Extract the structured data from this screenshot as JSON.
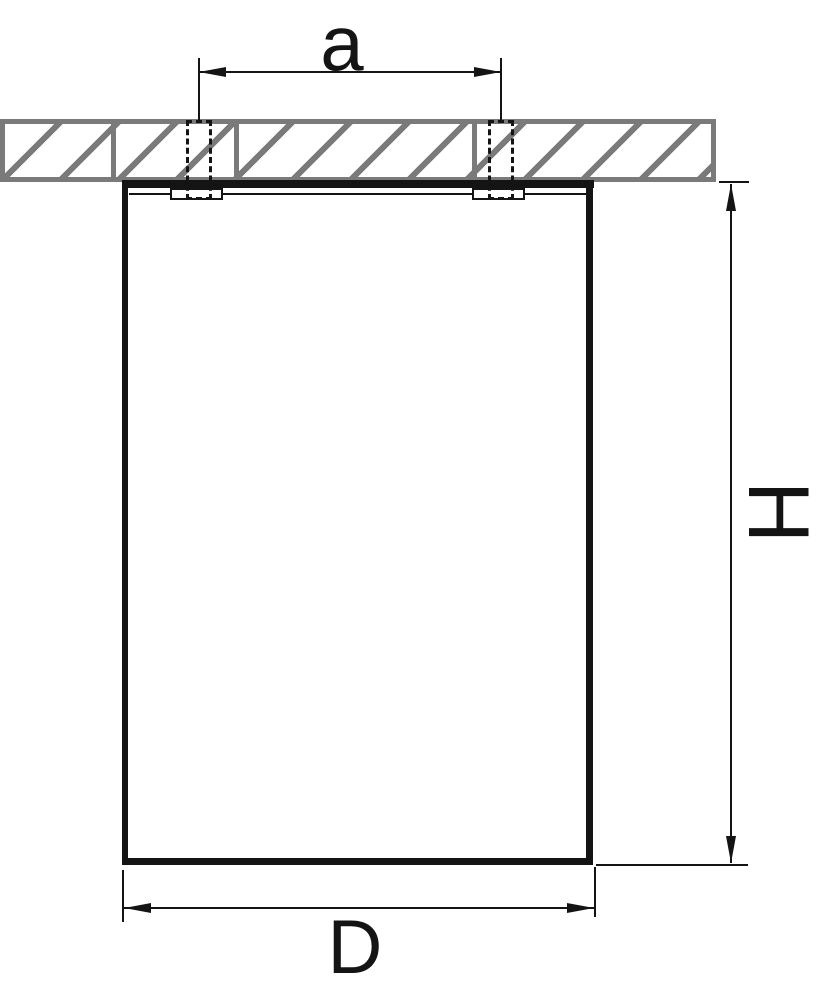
{
  "diagram": {
    "type": "technical-dimension-drawing",
    "subject": "surface-mounted cylindrical ceiling light fixture, side cross-section view",
    "dimension_labels": {
      "mounting_hole_spacing": "a",
      "fixture_height": "H",
      "fixture_diameter": "D"
    },
    "parts": [
      "ceiling cross-section (hatched)",
      "left mounting screw (hidden outline, dashed)",
      "right mounting screw (hidden outline, dashed)",
      "fixture body (cylinder outline)"
    ],
    "colors": {
      "ceiling_gray": "#7a7a7a",
      "line_black": "#141414",
      "background": "#ffffff"
    }
  }
}
